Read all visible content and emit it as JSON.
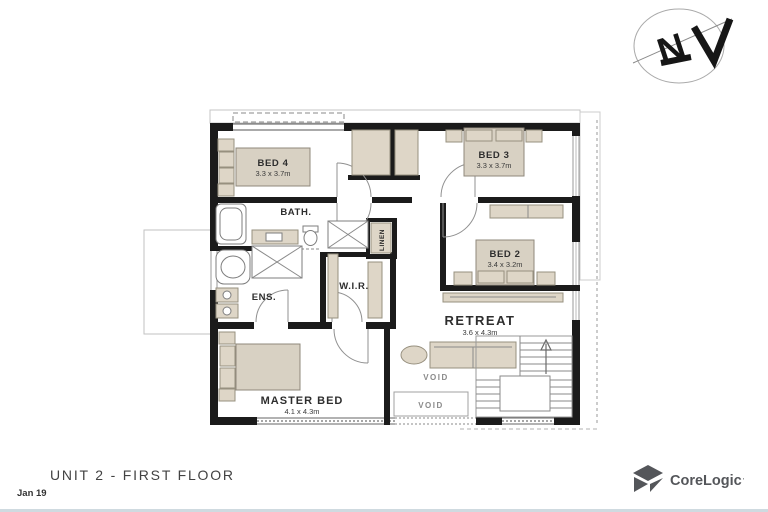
{
  "page": {
    "title": "UNIT 2 - FIRST FLOOR",
    "date": "Jan 19"
  },
  "branding": {
    "logo": "CoreLogic",
    "logo_mark": "'",
    "logo_color": "#54565A"
  },
  "compass": {
    "north": "N"
  },
  "floorplan": {
    "rooms": {
      "bed4": {
        "name": "BED 4",
        "dims": "3.3 x 3.7m"
      },
      "bed3": {
        "name": "BED 3",
        "dims": "3.3 x 3.7m"
      },
      "bed2": {
        "name": "BED 2",
        "dims": "3.4 x 3.2m"
      },
      "master": {
        "name": "MASTER BED",
        "dims": "4.1 x 4.3m"
      },
      "retreat": {
        "name": "RETREAT",
        "dims": "3.6 x 4.3m"
      },
      "bath": {
        "name": "BATH."
      },
      "ens": {
        "name": "ENS."
      },
      "wir": {
        "name": "W.I.R."
      },
      "linen": {
        "name": "LINEN"
      },
      "void_upper": {
        "name": "VOID"
      },
      "void_lower": {
        "name": "VOID"
      }
    },
    "colors": {
      "wall": "#1b1b1b",
      "furniture": "#ded6c7",
      "furniture_stroke": "#97907f",
      "line": "#8a8a8a",
      "logo": "#54565A"
    }
  }
}
